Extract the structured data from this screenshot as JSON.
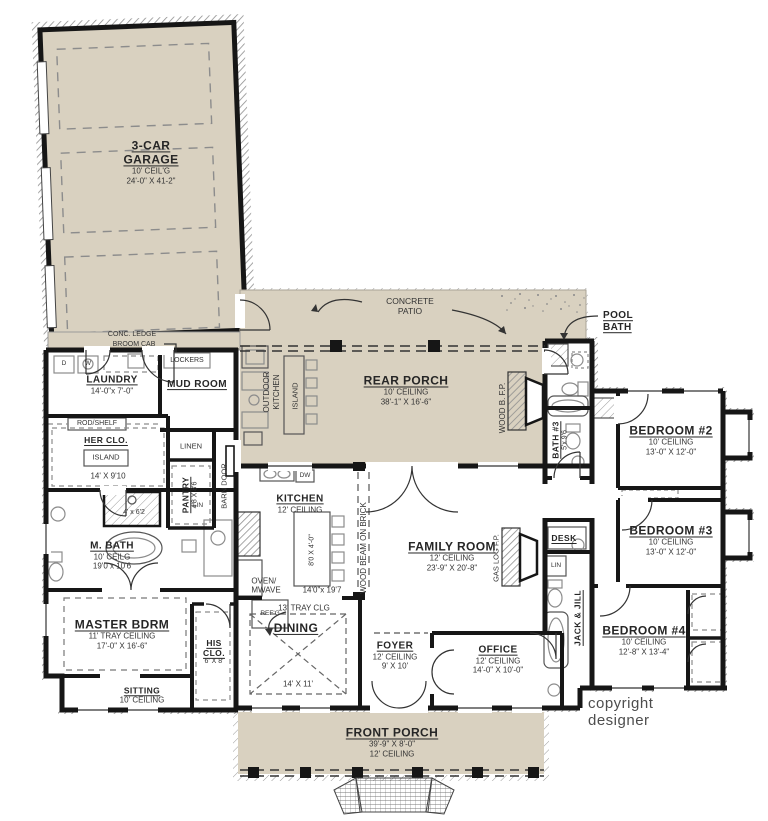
{
  "page": {
    "copyright": "copyright designer"
  },
  "colors": {
    "porch_fill": "#d9d1c0",
    "wall": "#161616",
    "fixture_gray": "#8c8c8c",
    "label_text": "#2e2e2e"
  },
  "rooms": {
    "garage": {
      "title": "3-CAR GARAGE",
      "ceiling": "10' CEIL'G",
      "dims": "24'-0\" X 41-2\""
    },
    "laundry": {
      "title": "LAUNDRY",
      "dims": "14'-0\"x 7'-0\""
    },
    "mud_room": {
      "title": "MUD ROOM"
    },
    "her_closet": {
      "title": "HER CLO.",
      "island": "ISLAND",
      "dims": "14' X 9'10"
    },
    "pantry": {
      "title": "PANTRY",
      "dims": "4'8 X 8'6"
    },
    "master_bath": {
      "title": "M. BATH",
      "ceiling": "10' CEILG",
      "dims": "19'0 x 10'6",
      "shower_dims": "4' x 6'2"
    },
    "master_bedroom": {
      "title": "MASTER BDRM",
      "ceiling": "11' TRAY CEILING",
      "dims": "17'-0\" X 16'-6\""
    },
    "sitting": {
      "title": "SITTING",
      "ceiling": "10' CEILING"
    },
    "his_closet": {
      "title": "HIS\nCLO.",
      "dims": "6' X 8'"
    },
    "kitchen": {
      "title": "KITCHEN",
      "ceiling": "12' CEILING",
      "dims": "14'0\"x 19'7",
      "island_dims": "8'0 X 4'-0\""
    },
    "family_room": {
      "title": "FAMILY ROOM",
      "ceiling": "12' CEILING",
      "dims": "23'-9\" X 20'-8\""
    },
    "dining": {
      "title": "DINING",
      "ceiling": "13' TRAY CLG",
      "dims": "14' X 11'"
    },
    "foyer": {
      "title": "FOYER",
      "ceiling": "12' CEILING",
      "dims": "9' X 10'"
    },
    "office": {
      "title": "OFFICE",
      "ceiling": "12' CEILING",
      "dims": "14'-0\" X 10'-0\""
    },
    "rear_porch": {
      "title": "REAR PORCH",
      "ceiling": "10' CEILING",
      "dims": "38'-1\" X 16'-6\""
    },
    "front_porch": {
      "title": "FRONT PORCH",
      "dims": "39'-9\" X 8'-0\"",
      "ceiling": "12' CEILING"
    },
    "concrete_patio": {
      "title": "CONCRETE\nPATIO"
    },
    "pool_bath": {
      "title": "POOL\nBATH"
    },
    "bath3": {
      "title": "BATH #3",
      "dims": "5'x 9'6"
    },
    "bedroom2": {
      "title": "BEDROOM #2",
      "ceiling": "10' CEILING",
      "dims": "13'-0\" X 12'-0\""
    },
    "bedroom3": {
      "title": "BEDROOM #3",
      "ceiling": "10' CEILING",
      "dims": "13'-0\" X 12'-0\""
    },
    "bedroom4": {
      "title": "BEDROOM #4",
      "ceiling": "10' CEILING",
      "dims": "12'-8\" X 13'-4\""
    }
  },
  "annotations": {
    "conc_ledge": "CONC. LEDGE",
    "broom_cab": "BROOM CAB",
    "lockers": "LOCKERS",
    "rod_shelf": "ROD/SHELF",
    "linen": "LINEN",
    "lin_bath": "LIN",
    "lin_hall": "LIN",
    "barn_door": "BARN DOOR",
    "outdoor_kitchen": "OUTDOOR\nKITCHEN",
    "porch_island": "ISLAND",
    "wood_fireplace": "WOOD B. F.P.",
    "wood_beam": "WOOD BEAM ON BRICK",
    "gas_fireplace": "GAS LOG F.P.",
    "desk": "DESK",
    "jack_and_jill": "JACK & JILL",
    "oven_microwave": "OVEN/\nMWAVE",
    "refrigerator": "REF'G",
    "dishwasher": "DW",
    "dryer": "D",
    "washer": "W"
  }
}
